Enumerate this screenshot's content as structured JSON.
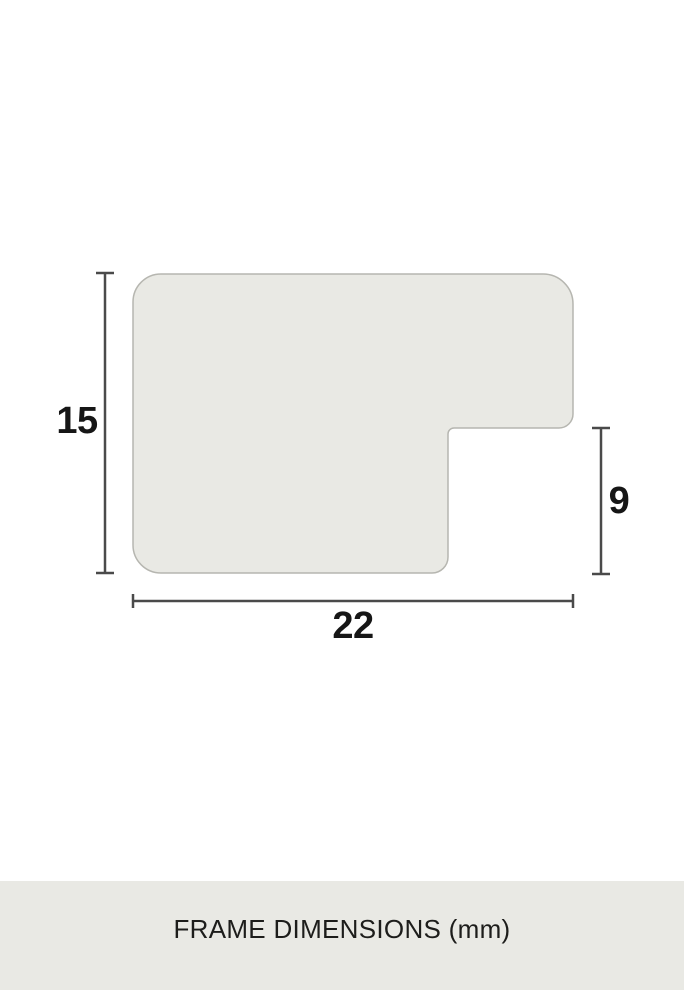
{
  "page": {
    "background": "#ffffff"
  },
  "diagram": {
    "description": "frame moulding profile cross-section with dimension lines",
    "unit": "mm",
    "labels": {
      "height": "15",
      "rabbet": "9",
      "width": "22"
    },
    "colors": {
      "shape_fill": "#e9e9e4",
      "shape_stroke": "#b6b6b0",
      "dimension_line": "#4a4a4a",
      "label_text": "#161616"
    }
  },
  "footer": {
    "caption": "FRAME DIMENSIONS (mm)",
    "background": "#e9e9e4",
    "text_color": "#1d1d1b"
  }
}
